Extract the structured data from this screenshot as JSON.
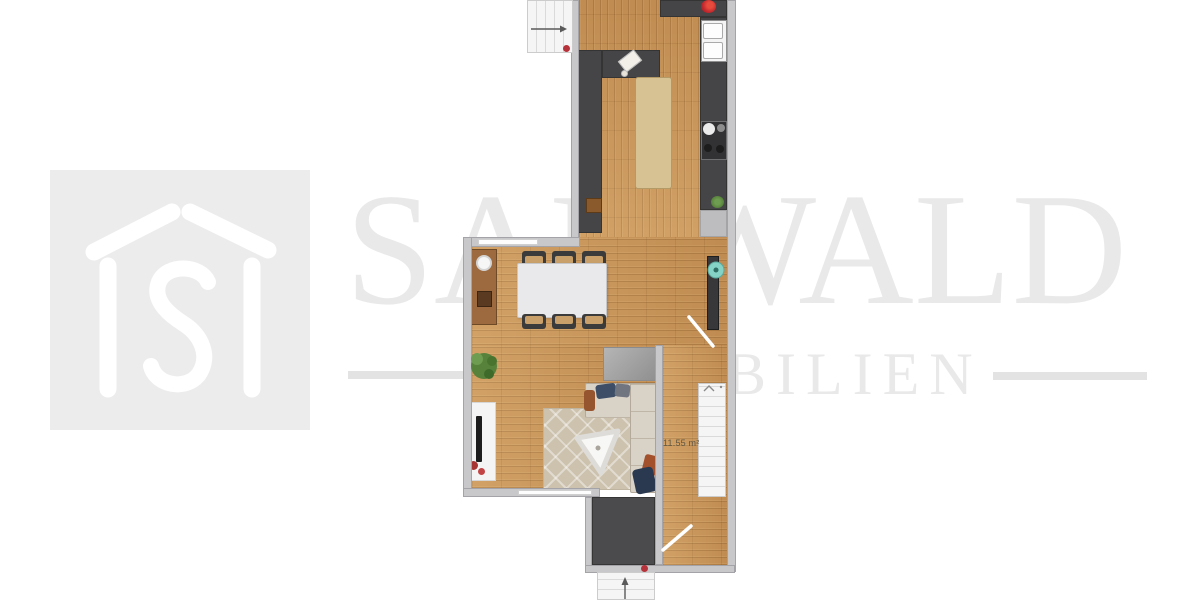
{
  "watermark": {
    "line1": "SANWALD",
    "line2": "IMMOBILIEN",
    "text_color": "#e9e9e9",
    "dash_color": "#e3e3e3"
  },
  "logo": {
    "letter": "S",
    "background": "#ececec",
    "stroke_color": "#ffffff"
  },
  "floorplan": {
    "living_room_area_label": "11.55 m²",
    "colors": {
      "wood_floor": "#c79357",
      "wall": "#c8c8ca",
      "kitchen_counter": "#454547",
      "dark_room_floor": "#4b4b4d",
      "kitchen_island": "#d6c293",
      "dining_table": "#e9e9eb",
      "sofa": "#d9d2c7",
      "rug": "#cdc2ae",
      "stairs": "#f5f5f5",
      "accent_red": "#c1272d",
      "plant_green": "#57823b",
      "teal_decor": "#85d2c6"
    },
    "icons": {
      "entry_arrow": "entry-arrow-icon",
      "stairs_up_arrow": "stairs-up-arrow-icon",
      "stairs_chevron": "stairs-chevron-icon",
      "door_swing": "door-swing",
      "house_logo": "house-logo-icon"
    }
  }
}
